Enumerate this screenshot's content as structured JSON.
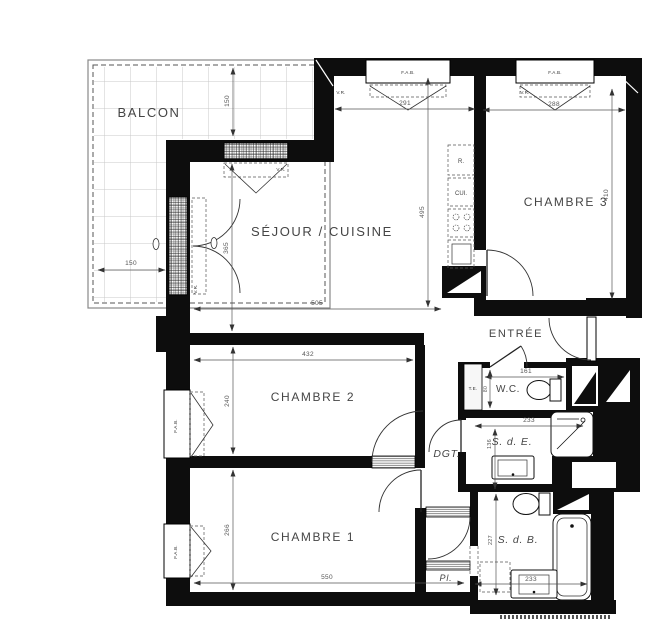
{
  "rooms": {
    "balcon": "BALCON",
    "sejour_cuisine": "SÉJOUR / CUISINE",
    "chambre1": "CHAMBRE 1",
    "chambre2": "CHAMBRE 2",
    "chambre3": "CHAMBRE 3",
    "entree": "ENTRÉE",
    "wc": "W.C.",
    "salle_deau": "S. d. E.",
    "salle_de_bains": "S. d. B.",
    "degagement": "DGT.",
    "placard": "Pl.",
    "refrigerateur": "R.",
    "cuisine": "CUI.",
    "tableau_electrique": "T.E."
  },
  "windows": {
    "fab": "F.A.B.",
    "vr": "V.R."
  },
  "dims_cm": {
    "balcon_profondeur": "150",
    "balcon_largeur": "150",
    "baie_sejour": "291",
    "sejour_largeur": "505",
    "sejour_longueur": "365",
    "cuisine_longueur": "495",
    "chambre3_largeur": "288",
    "chambre3_longueur": "410",
    "chambre2_largeur": "432",
    "chambre2_longueur": "240",
    "chambre1_largeur": "550",
    "chambre1_longueur": "266",
    "wc_largeur": "161",
    "wc_profondeur": "80",
    "sde_largeur": "233",
    "sde_longueur": "136",
    "sdb_longueur": "227",
    "sdb_largeur": "233"
  },
  "colors": {
    "wall": "#0d0d0d",
    "line": "#333333",
    "dimension": "#555555",
    "tile_line": "#c9c9c9",
    "text": "#454545",
    "background": "#ffffff"
  }
}
